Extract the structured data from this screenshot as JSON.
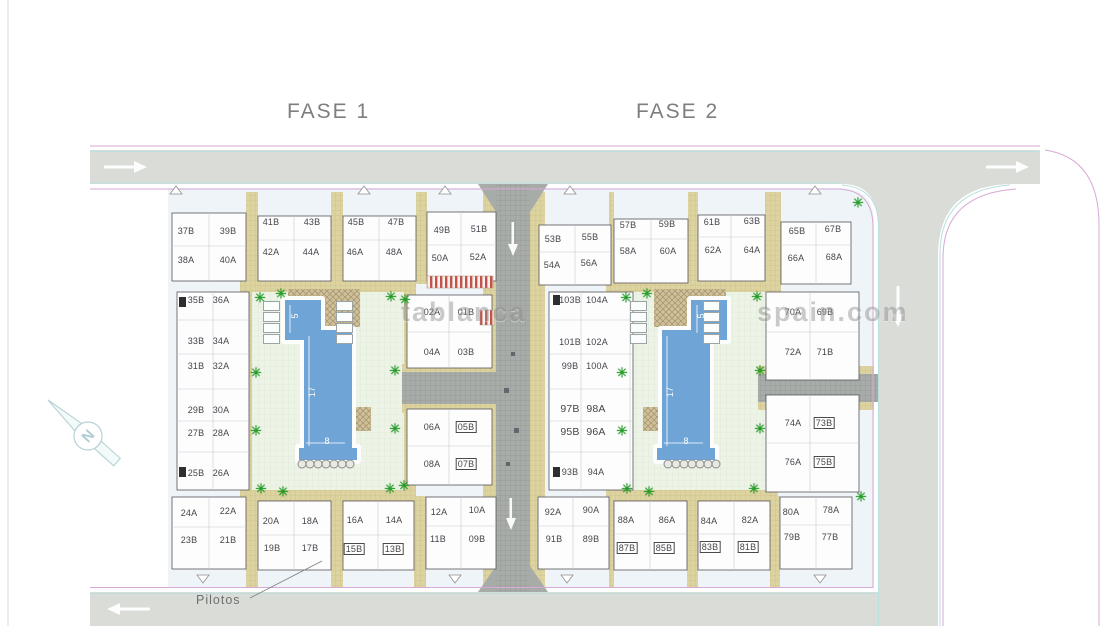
{
  "titles": {
    "fase1": "FASE 1",
    "fase2": "FASE 2"
  },
  "annotations": {
    "pilotos": "Pilotos"
  },
  "compass": {
    "letter": "N"
  },
  "watermark": {
    "left": "tablanca",
    "right": "spain.com"
  },
  "pools": [
    {
      "length_label": "17",
      "len_x": 312,
      "len_y": 392,
      "width_label": "8",
      "wid_x": 327,
      "wid_y": 441,
      "small_label": "5",
      "small_x": 295,
      "small_y": 316
    },
    {
      "length_label": "17",
      "len_x": 670,
      "len_y": 392,
      "width_label": "8",
      "wid_x": 686,
      "wid_y": 441,
      "small_label": "5",
      "small_x": 701,
      "small_y": 316
    }
  ],
  "decor": {
    "palm_glyph": "✳",
    "palms": [
      [
        260,
        298
      ],
      [
        281,
        294
      ],
      [
        391,
        297
      ],
      [
        405,
        300
      ],
      [
        256,
        373
      ],
      [
        256,
        431
      ],
      [
        395,
        371
      ],
      [
        395,
        429
      ],
      [
        261,
        489
      ],
      [
        283,
        492
      ],
      [
        390,
        489
      ],
      [
        404,
        486
      ],
      [
        626,
        298
      ],
      [
        647,
        294
      ],
      [
        757,
        297
      ],
      [
        622,
        373
      ],
      [
        622,
        431
      ],
      [
        760,
        371
      ],
      [
        760,
        429
      ],
      [
        627,
        489
      ],
      [
        649,
        492
      ],
      [
        754,
        489
      ],
      [
        858,
        203
      ],
      [
        861,
        497
      ]
    ],
    "parasol_rows": [
      {
        "x": 302,
        "y": 464,
        "count": 7,
        "step": 8
      },
      {
        "x": 668,
        "y": 464,
        "count": 7,
        "step": 8
      }
    ],
    "lounger_cols": [
      {
        "x": 263,
        "y": 301,
        "count": 4,
        "step": 11
      },
      {
        "x": 336,
        "y": 301,
        "count": 4,
        "step": 11
      },
      {
        "x": 630,
        "y": 301,
        "count": 4,
        "step": 11
      },
      {
        "x": 703,
        "y": 301,
        "count": 4,
        "step": 11
      }
    ]
  },
  "units": [
    {
      "n": "37B",
      "x": 186,
      "y": 231
    },
    {
      "n": "39B",
      "x": 228,
      "y": 231
    },
    {
      "n": "38A",
      "x": 186,
      "y": 260
    },
    {
      "n": "40A",
      "x": 228,
      "y": 260
    },
    {
      "n": "41B",
      "x": 271,
      "y": 222
    },
    {
      "n": "43B",
      "x": 312,
      "y": 222
    },
    {
      "n": "42A",
      "x": 271,
      "y": 252
    },
    {
      "n": "44A",
      "x": 311,
      "y": 252
    },
    {
      "n": "45B",
      "x": 356,
      "y": 222
    },
    {
      "n": "47B",
      "x": 396,
      "y": 222
    },
    {
      "n": "46A",
      "x": 355,
      "y": 252
    },
    {
      "n": "48A",
      "x": 394,
      "y": 252
    },
    {
      "n": "49B",
      "x": 442,
      "y": 230
    },
    {
      "n": "51B",
      "x": 479,
      "y": 229
    },
    {
      "n": "50A",
      "x": 440,
      "y": 258
    },
    {
      "n": "52A",
      "x": 478,
      "y": 257
    },
    {
      "n": "53B",
      "x": 553,
      "y": 239
    },
    {
      "n": "55B",
      "x": 590,
      "y": 237
    },
    {
      "n": "54A",
      "x": 552,
      "y": 265
    },
    {
      "n": "56A",
      "x": 589,
      "y": 263
    },
    {
      "n": "57B",
      "x": 628,
      "y": 225
    },
    {
      "n": "59B",
      "x": 667,
      "y": 224
    },
    {
      "n": "58A",
      "x": 628,
      "y": 251
    },
    {
      "n": "60A",
      "x": 668,
      "y": 251
    },
    {
      "n": "61B",
      "x": 712,
      "y": 222
    },
    {
      "n": "63B",
      "x": 752,
      "y": 221
    },
    {
      "n": "62A",
      "x": 713,
      "y": 250
    },
    {
      "n": "64A",
      "x": 752,
      "y": 250
    },
    {
      "n": "65B",
      "x": 797,
      "y": 231
    },
    {
      "n": "67B",
      "x": 833,
      "y": 229
    },
    {
      "n": "66A",
      "x": 796,
      "y": 258
    },
    {
      "n": "68A",
      "x": 834,
      "y": 257
    },
    {
      "n": "35B",
      "x": 196,
      "y": 300
    },
    {
      "n": "36A",
      "x": 221,
      "y": 300
    },
    {
      "n": "33B",
      "x": 196,
      "y": 341
    },
    {
      "n": "34A",
      "x": 221,
      "y": 341
    },
    {
      "n": "31B",
      "x": 196,
      "y": 366
    },
    {
      "n": "32A",
      "x": 221,
      "y": 366
    },
    {
      "n": "29B",
      "x": 196,
      "y": 410
    },
    {
      "n": "30A",
      "x": 221,
      "y": 410
    },
    {
      "n": "27B",
      "x": 196,
      "y": 433
    },
    {
      "n": "28A",
      "x": 221,
      "y": 433
    },
    {
      "n": "25B",
      "x": 196,
      "y": 473
    },
    {
      "n": "26A",
      "x": 221,
      "y": 473
    },
    {
      "n": "02A",
      "x": 432,
      "y": 312
    },
    {
      "n": "01B",
      "x": 466,
      "y": 312
    },
    {
      "n": "04A",
      "x": 432,
      "y": 352
    },
    {
      "n": "03B",
      "x": 466,
      "y": 352
    },
    {
      "n": "06A",
      "x": 432,
      "y": 427
    },
    {
      "n": "05B",
      "x": 466,
      "y": 427,
      "box": true
    },
    {
      "n": "08A",
      "x": 432,
      "y": 464
    },
    {
      "n": "07B",
      "x": 466,
      "y": 464,
      "box": true
    },
    {
      "n": "103B",
      "x": 570,
      "y": 300
    },
    {
      "n": "104A",
      "x": 597,
      "y": 300
    },
    {
      "n": "101B",
      "x": 570,
      "y": 342
    },
    {
      "n": "102A",
      "x": 597,
      "y": 342
    },
    {
      "n": "99B",
      "x": 570,
      "y": 366
    },
    {
      "n": "100A",
      "x": 597,
      "y": 366
    },
    {
      "n": "97B",
      "x": 570,
      "y": 409,
      "s": 10.5
    },
    {
      "n": "98A",
      "x": 596,
      "y": 409,
      "s": 10.5
    },
    {
      "n": "95B",
      "x": 570,
      "y": 432,
      "s": 10.5
    },
    {
      "n": "96A",
      "x": 596,
      "y": 432,
      "s": 10.5
    },
    {
      "n": "93B",
      "x": 570,
      "y": 472
    },
    {
      "n": "94A",
      "x": 596,
      "y": 472
    },
    {
      "n": "70A",
      "x": 793,
      "y": 312
    },
    {
      "n": "69B",
      "x": 825,
      "y": 312
    },
    {
      "n": "72A",
      "x": 793,
      "y": 352
    },
    {
      "n": "71B",
      "x": 825,
      "y": 352
    },
    {
      "n": "74A",
      "x": 793,
      "y": 423
    },
    {
      "n": "73B",
      "x": 824,
      "y": 423,
      "box": true
    },
    {
      "n": "76A",
      "x": 793,
      "y": 462
    },
    {
      "n": "75B",
      "x": 824,
      "y": 462,
      "box": true
    },
    {
      "n": "24A",
      "x": 189,
      "y": 513
    },
    {
      "n": "22A",
      "x": 228,
      "y": 511
    },
    {
      "n": "23B",
      "x": 189,
      "y": 540
    },
    {
      "n": "21B",
      "x": 228,
      "y": 540
    },
    {
      "n": "20A",
      "x": 271,
      "y": 521
    },
    {
      "n": "18A",
      "x": 310,
      "y": 521
    },
    {
      "n": "19B",
      "x": 272,
      "y": 548
    },
    {
      "n": "17B",
      "x": 310,
      "y": 548
    },
    {
      "n": "16A",
      "x": 355,
      "y": 520
    },
    {
      "n": "14A",
      "x": 394,
      "y": 520
    },
    {
      "n": "15B",
      "x": 354,
      "y": 549,
      "box": true
    },
    {
      "n": "13B",
      "x": 393,
      "y": 549,
      "box": true
    },
    {
      "n": "12A",
      "x": 439,
      "y": 512
    },
    {
      "n": "10A",
      "x": 477,
      "y": 510
    },
    {
      "n": "11B",
      "x": 438,
      "y": 539
    },
    {
      "n": "09B",
      "x": 477,
      "y": 539
    },
    {
      "n": "92A",
      "x": 553,
      "y": 512
    },
    {
      "n": "90A",
      "x": 591,
      "y": 510
    },
    {
      "n": "91B",
      "x": 554,
      "y": 539
    },
    {
      "n": "89B",
      "x": 591,
      "y": 539
    },
    {
      "n": "88A",
      "x": 626,
      "y": 520
    },
    {
      "n": "86A",
      "x": 667,
      "y": 520
    },
    {
      "n": "87B",
      "x": 627,
      "y": 548,
      "box": true
    },
    {
      "n": "85B",
      "x": 664,
      "y": 548,
      "box": true
    },
    {
      "n": "84A",
      "x": 709,
      "y": 521
    },
    {
      "n": "82A",
      "x": 750,
      "y": 520
    },
    {
      "n": "83B",
      "x": 710,
      "y": 547,
      "box": true
    },
    {
      "n": "81B",
      "x": 748,
      "y": 547,
      "box": true
    },
    {
      "n": "80A",
      "x": 791,
      "y": 512
    },
    {
      "n": "78A",
      "x": 831,
      "y": 510
    },
    {
      "n": "79B",
      "x": 792,
      "y": 537
    },
    {
      "n": "77B",
      "x": 830,
      "y": 537
    }
  ],
  "colors": {
    "road": "#dadcd8",
    "path_tan": "#dcd3a0",
    "courtyard": "#edf3e7",
    "pool_blue": "#6fa4d6",
    "boundary_pink": "#d7a9d7",
    "sidewalk_cyan": "#b9dfe0",
    "palm_green": "#1da021",
    "title_gray": "#7e7e80"
  }
}
